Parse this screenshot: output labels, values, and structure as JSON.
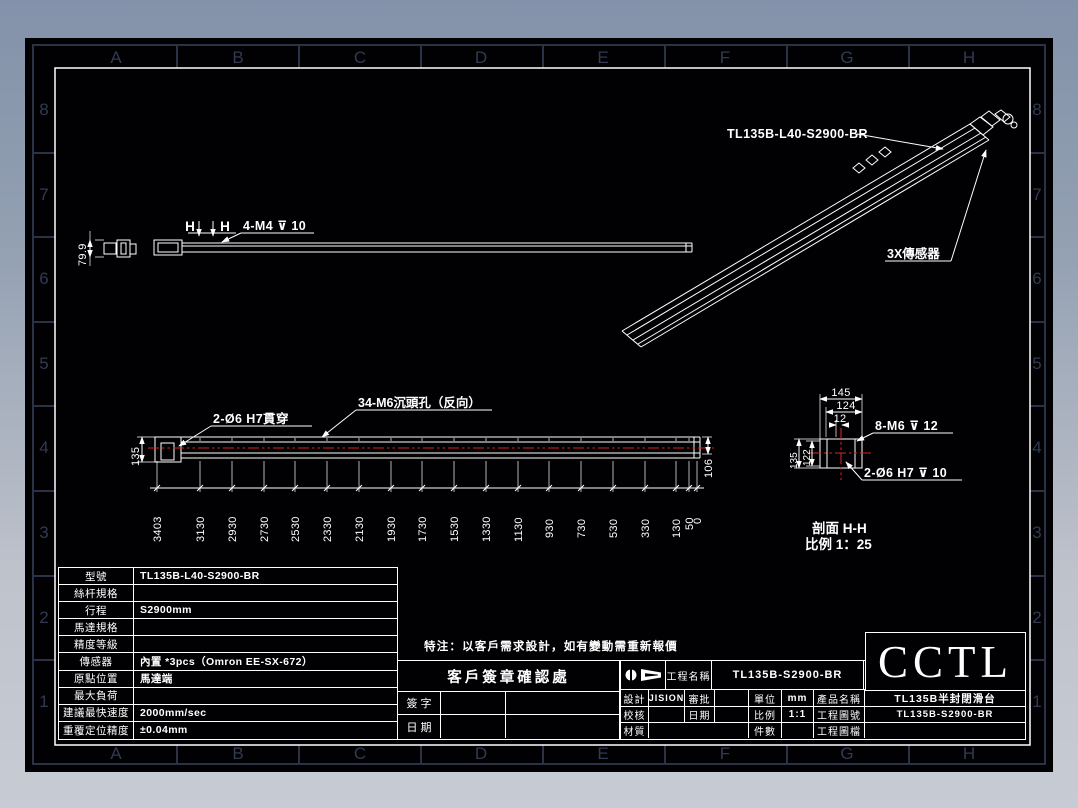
{
  "frame": {
    "cols": [
      "A",
      "B",
      "C",
      "D",
      "E",
      "F",
      "G",
      "H"
    ],
    "rows": [
      "8",
      "7",
      "6",
      "5",
      "4",
      "3",
      "2",
      "1"
    ]
  },
  "iso_view": {
    "part_label": "TL135B-L40-S2900-BR",
    "sensor_label": "3X傳感器"
  },
  "top_view": {
    "h_left": "H",
    "h_right": "H",
    "hole_note": "4-M4 ⊽ 10",
    "end_height": "79.9"
  },
  "front_view": {
    "through_note": "2-Ø6 H7貫穿",
    "csk_note": "34-M6沉頭孔（反向）",
    "height_left": "135",
    "height_right": "106",
    "positions": [
      "3403",
      "3130",
      "2930",
      "2730",
      "2530",
      "2330",
      "2130",
      "1930",
      "1730",
      "1530",
      "1330",
      "1130",
      "930",
      "730",
      "530",
      "330",
      "130",
      "50",
      "0"
    ]
  },
  "section_view": {
    "w1": "145",
    "w2": "124",
    "w3": "12",
    "h1": "135",
    "h2": "122",
    "tap_note": "8-M6 ⊽ 12",
    "pin_note": "2-Ø6 H7 ⊽ 10",
    "caption": "剖面 H-H",
    "scale_note": "比例 1：25"
  },
  "spec_table": {
    "rows": [
      {
        "label": "型號",
        "value": "TL135B-L40-S2900-BR"
      },
      {
        "label": "絲杆規格",
        "value": ""
      },
      {
        "label": "行程",
        "value": "S2900mm"
      },
      {
        "label": "馬達規格",
        "value": ""
      },
      {
        "label": "精度等級",
        "value": ""
      },
      {
        "label": "傳感器",
        "value": "內置 *3pcs（Omron EE-SX-672）"
      },
      {
        "label": "原點位置",
        "value": "馬達端"
      },
      {
        "label": "最大負荷",
        "value": ""
      },
      {
        "label": "建議最快速度",
        "value": "2000mm/sec"
      },
      {
        "label": "重覆定位精度",
        "value": "±0.04mm"
      }
    ]
  },
  "note_text": "特注：以客戶需求設計，如有變動需重新報價",
  "signature": {
    "title": "客戶簽章確認處",
    "sign": "簽 字",
    "date": "日 期"
  },
  "title_block": {
    "project_label": "工程名稱",
    "project_value": "TL135B-S2900-BR",
    "design_label": "設計",
    "design_value": "JISION",
    "approve_label": "審批",
    "unit_label": "單位",
    "unit_value": "mm",
    "product_label": "產品名稱",
    "product_value": "TL135B半封閉滑台",
    "check_label": "校核",
    "date_label": "日期",
    "scale_label": "比例",
    "scale_value": "1:1",
    "dwgno_label": "工程圖號",
    "dwgno_value": "TL135B-S2900-BR",
    "material_label": "材質",
    "qty_label": "件數",
    "file_label": "工程圖檔",
    "logo": "CCTL"
  }
}
